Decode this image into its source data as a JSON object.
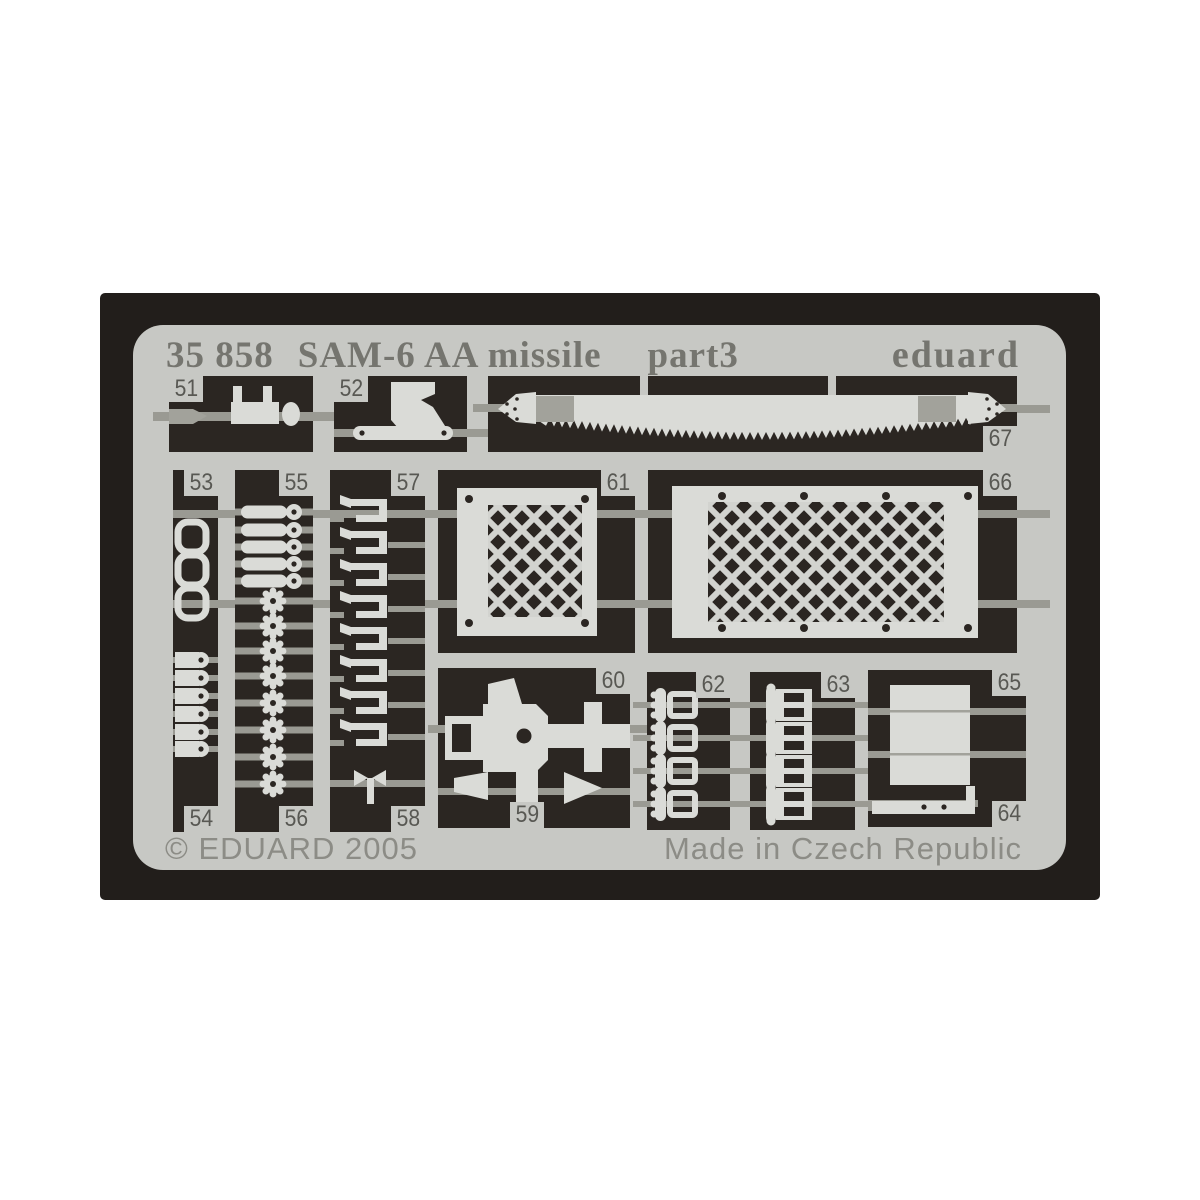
{
  "header": {
    "catalog_number": "35 858",
    "product_title": "SAM-6 AA missile",
    "part_label": "part3",
    "brand": "eduard"
  },
  "footer": {
    "copyright": "© EDUARD 2005",
    "made_in": "Made in Czech Republic"
  },
  "fret": {
    "part_numbers": {
      "n51": "51",
      "n52": "52",
      "n53": "53",
      "n54": "54",
      "n55": "55",
      "n56": "56",
      "n57": "57",
      "n58": "58",
      "n59": "59",
      "n60": "60",
      "n61": "61",
      "n62": "62",
      "n63": "63",
      "n64": "64",
      "n65": "65",
      "n66": "66",
      "n67": "67"
    },
    "part_shapes": {
      "51": "rod-with-posts-part",
      "52": "angled-bracket-part",
      "53": "u-bracket-parts",
      "54": "latch-pin-parts",
      "55": "handle-pin-parts",
      "56": "sprocket-wheel-parts",
      "57": "spring-clip-parts",
      "58": "wing-screw-part",
      "59": "wedge-parts",
      "60": "machine-gun-body-part",
      "61": "square-mesh-screen-part",
      "62": "buckle-parts",
      "63": "double-buckle-parts",
      "64": "slide-rail-part",
      "65": "box-panel-part",
      "66": "rectangular-mesh-screen-part",
      "67": "saw-blade-part"
    }
  },
  "colors": {
    "background": "#ffffff",
    "backdrop": "#221e1b",
    "plate": "#c7c8c4",
    "panel_cutout": "#2b2622",
    "part": "#dadbd7",
    "runner": "#9a9a93",
    "header_text": "#75756f",
    "tab_text": "#585853",
    "footer_text": "#8c8c86"
  }
}
